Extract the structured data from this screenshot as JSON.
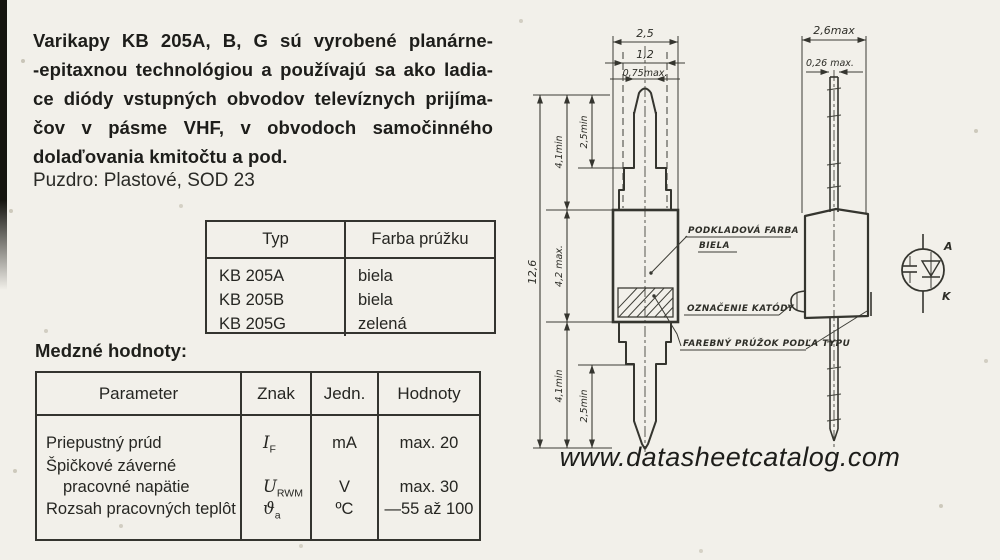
{
  "colors": {
    "paper": "#f2f0ea",
    "ink": "#22221f"
  },
  "intro_lines": [
    "Varikapy KB 205A, B, G sú vyrobené planárne-",
    "-epitaxnou technológiou a používajú sa ako ladia-",
    "ce diódy vstupných obvodov televíznych prijíma-",
    "čov v pásme VHF, v obvodoch samočinného",
    "dolaďovania kmitočtu a pod."
  ],
  "package_line": "Puzdro: Plastové, SOD 23",
  "type_table": {
    "col_typ": "Typ",
    "col_farba": "Farba prúžku",
    "rows": [
      {
        "typ": "KB 205A",
        "farba": "biela"
      },
      {
        "typ": "KB 205B",
        "farba": "biela"
      },
      {
        "typ": "KB 205G",
        "farba": "zelená"
      }
    ]
  },
  "limits": {
    "heading": "Medzné hodnoty:",
    "col_parameter": "Parameter",
    "col_znak": "Znak",
    "col_jedn": "Jedn.",
    "col_hodnoty": "Hodnoty",
    "row1": {
      "param": "Priepustný prúd",
      "sym": "I",
      "sub": "F",
      "unit": "mA",
      "val": "max. 20"
    },
    "row2": {
      "param_line1": "Špičkové záverné",
      "param_line2": "pracovné napätie",
      "sym": "U",
      "sub": "RWM",
      "unit": "V",
      "val": "max. 30"
    },
    "row3": {
      "param": "Rozsah pracovných teplôt",
      "sym": "ϑ",
      "sub": "a",
      "unit": "ºC",
      "val": "—55 až 100"
    }
  },
  "front_view": {
    "dim_width_body": "2,5",
    "dim_width_step": "1,2",
    "dim_width_lead": "0,75max.",
    "dim_total": "12,6",
    "dim_lead_top": "4,1min",
    "dim_tip_top": "2,5min",
    "dim_body": "4,2 max.",
    "dim_lead_bottom": "4,1min",
    "dim_tip_bottom": "2,5min",
    "callout_base_line1": "PODKLADOVÁ FARBA",
    "callout_base_line2": "BIELA",
    "callout_cathode": "OZNAČENIE KATÓDY",
    "callout_stripe": "FAREBNÝ PRÚŽOK PODĽA TYPU"
  },
  "side_view": {
    "dim_width": "2,6max",
    "dim_thickness": "0,26 max."
  },
  "symbol": {
    "anode": "A",
    "cathode": "K"
  },
  "watermark": "www.datasheetcatalog.com"
}
